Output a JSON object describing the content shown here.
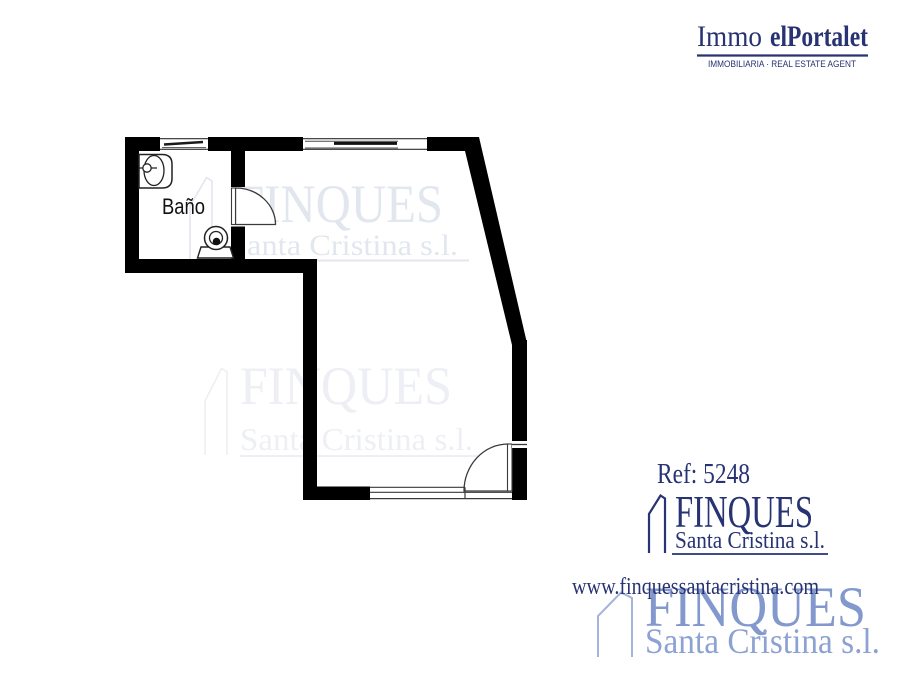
{
  "header": {
    "brand_prefix": "Immo",
    "brand_name": "elPortalet",
    "tagline": "IMMOBILIARIA · REAL ESTATE AGENT"
  },
  "floorplan": {
    "room_label": "Baño"
  },
  "watermark": {
    "brand": "FINQUES",
    "subtitle": "Santa Cristina s.l."
  },
  "footer": {
    "reference": "Ref: 5248",
    "brand": "FINQUES",
    "brand_subtitle": "Santa Cristina s.l.",
    "website": "www.finquessantacristina.com"
  },
  "colors": {
    "navy": "#273372",
    "periwinkle": "#8399cd",
    "watermark_light": "#e2e6ef",
    "watermark_lighter": "#edeff4",
    "wall": "#000000"
  }
}
